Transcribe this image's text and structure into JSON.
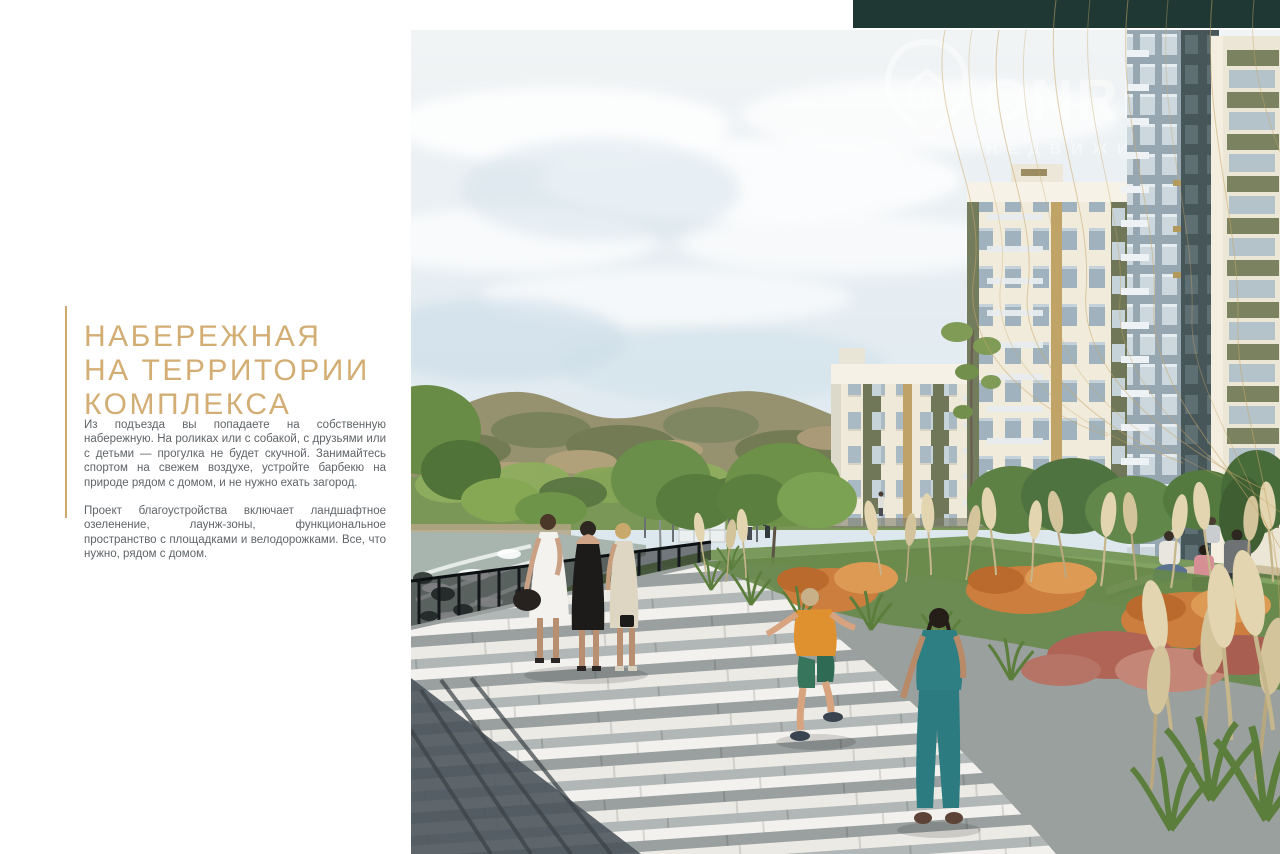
{
  "left_panel": {
    "heading": {
      "lines": [
        "НАБЕРЕЖНАЯ",
        "НА ТЕРРИТОРИИ",
        "КОМПЛЕКСА"
      ],
      "color": "#d3ae74"
    },
    "paragraphs": [
      "Из подъезда вы попадаете на собственную набережную. На роликах или с собакой, с друзьями или с детьми — прогулка не будет скучной. Занимайтесь спортом на свежем воздухе, устройте барбекю на природе рядом с домом, и не нужно ехать загород.",
      "Проект благоустройства включает ландшафтное озеленение, лаунж-зоны, функциональное пространство с площадками и велодорожками. Все, что нужно, рядом с домом."
    ],
    "text_color": "#5f6468"
  },
  "header_bar": {
    "color": "#1f3833"
  },
  "photo": {
    "watermark": {
      "brand": "ONRE",
      "subtitle": "НЕДВИЖИ"
    }
  },
  "decor": {
    "gold_line_color": "#c9a868",
    "accent_line_color": "#cfa76f"
  }
}
